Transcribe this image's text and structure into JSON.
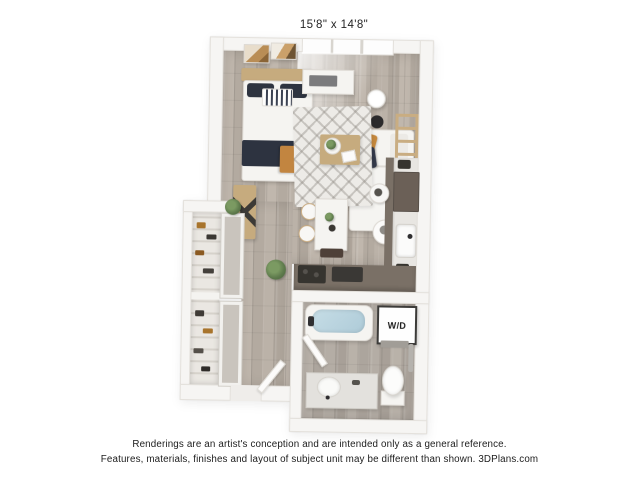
{
  "plan": {
    "dimensions_label": "15'8\" x 14'8\"",
    "washer_dryer_label": "W/D",
    "rooms": [
      "bedroom-living",
      "kitchen",
      "bathroom",
      "closet",
      "entry-hall"
    ],
    "features": [
      "bed",
      "art-frames",
      "window",
      "media-console",
      "floor-lamp",
      "side-table",
      "sofa",
      "throw-pillows",
      "blanket-ladder",
      "area-rug",
      "coffee-table",
      "bench",
      "dining-table",
      "dining-chairs",
      "plants",
      "kitchen-counter",
      "kitchen-sink",
      "refrigerator",
      "cooktop",
      "bathtub",
      "washer-dryer",
      "toilet",
      "vanity-sink",
      "bathroom-door",
      "entry-door",
      "closet-shelves",
      "closet-doors",
      "towel-bar"
    ],
    "colors": {
      "wall": "#f6f5f3",
      "floor_wood": "#bab1a7",
      "kitchen_cabinet": "#7a7066",
      "appliance_dark": "#36342f",
      "bed_navy": "#2e3440",
      "accent_orange": "#c28540",
      "tub_water": "#b9d4df",
      "rug": "#edebe7",
      "wood_furniture": "#c6ab7e",
      "plant_green": "#5e7a4c"
    }
  },
  "footer": {
    "line1": "Renderings are an artist's conception and are intended only as a general reference.",
    "line2": "Features, materials, finishes and layout of subject unit may be different than shown. 3DPlans.com"
  }
}
